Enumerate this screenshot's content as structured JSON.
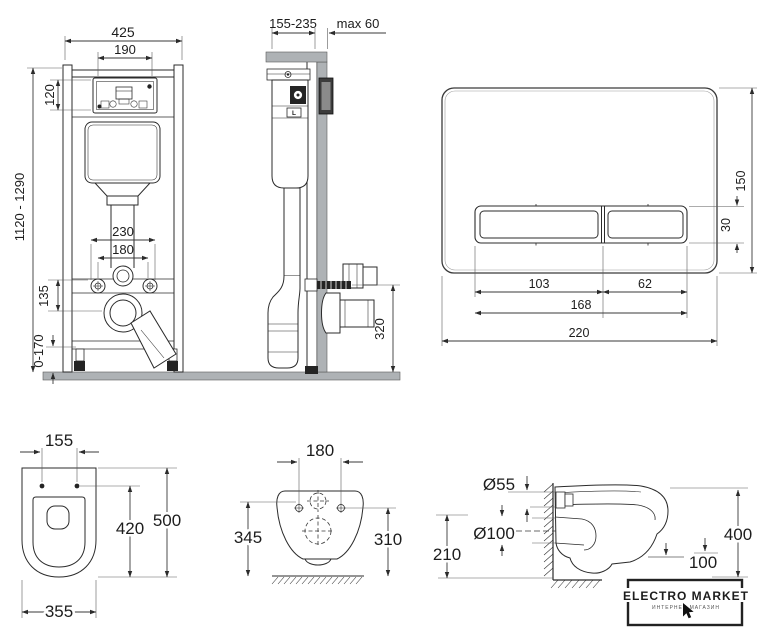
{
  "frame_front": {
    "width": "425",
    "opening_width": "190",
    "opening_height": "120",
    "height_range": "1120 - 1290",
    "fixing_span_outer": "230",
    "fixing_span_inner": "180",
    "outlet_drop": "135",
    "feet_range": "0-170"
  },
  "frame_side": {
    "depth_range": "155-235",
    "wall_max": "max 60",
    "outlet_height": "320",
    "level_mark": "L"
  },
  "flush_plate": {
    "height": "150",
    "button_height": "30",
    "button_large_width": "103",
    "button_small_width": "62",
    "buttons_width": "168",
    "width": "220"
  },
  "bowl_top": {
    "bolt_spacing": "155",
    "inner_length": "420",
    "length": "500",
    "width": "355"
  },
  "bowl_rear": {
    "bolt_spacing": "180",
    "height_left": "345",
    "height_right": "310"
  },
  "bowl_side": {
    "inlet_diameter": "Ø55",
    "drain_diameter": "Ø100",
    "drain_height": "210",
    "depth": "400",
    "clearance": "100"
  },
  "logo": {
    "title": "ELECTRO MARKET",
    "subtitle": "ИНТЕРНЕТ-МАГАЗИН"
  }
}
